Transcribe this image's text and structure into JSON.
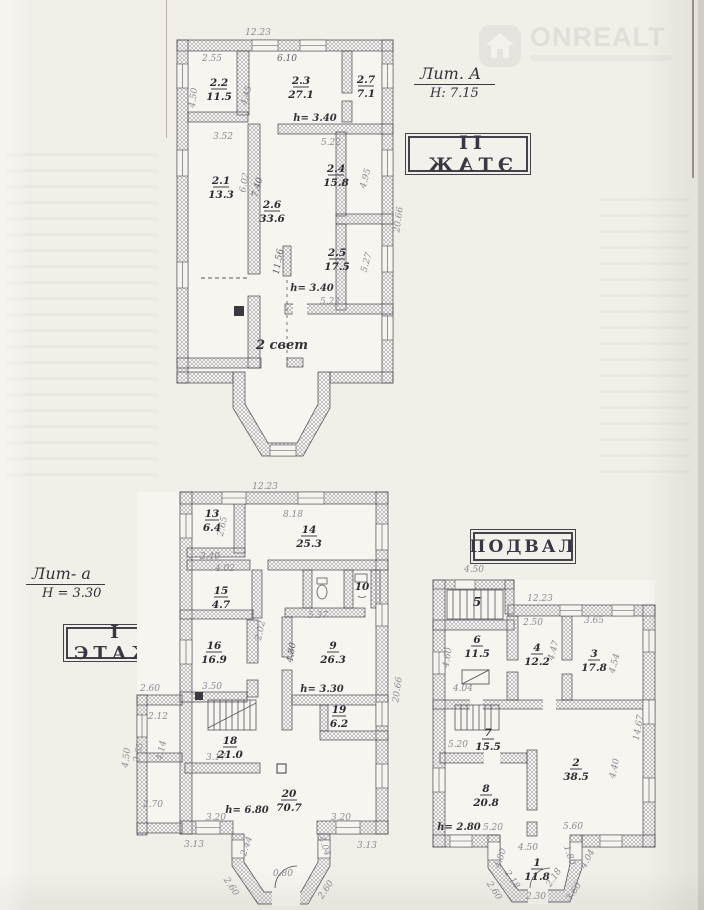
{
  "watermark": {
    "brand": "ONREALT"
  },
  "floor2": {
    "stamp": "II ЭТАЖ",
    "lit": "Лит. А",
    "height_note": "H: 7.15",
    "rooms": [
      {
        "num": "2.2",
        "area": "11.5"
      },
      {
        "num": "2.3",
        "area": "27.1"
      },
      {
        "num": "2.7",
        "area": "7.1"
      },
      {
        "num": "2.1",
        "area": "13.3"
      },
      {
        "num": "2.4",
        "area": "15.8"
      },
      {
        "num": "2.6",
        "area": "33.6"
      },
      {
        "num": "2.5",
        "area": "17.5"
      }
    ],
    "notes": [
      "h= 3.40",
      "h= 3.40",
      "2 свет"
    ],
    "dims": [
      "12.23",
      "2.55",
      "6.10",
      "4.50",
      "4.45",
      "3.52",
      "5.22",
      "6.02",
      "7.40",
      "4.95",
      "20.66",
      "11.56",
      "5.27",
      "5.22"
    ]
  },
  "floor1": {
    "stamp": "I ЭТАЖ",
    "lit": "Лит- а",
    "height_note": "H = 3.30",
    "rooms": [
      {
        "num": "13",
        "area": "6.4"
      },
      {
        "num": "14",
        "area": "25.3"
      },
      {
        "num": "15",
        "area": "4.7"
      },
      {
        "num": "16",
        "area": "16.9"
      },
      {
        "num": "9",
        "area": "26.3"
      },
      {
        "num": "19",
        "area": "6.2"
      },
      {
        "num": "18",
        "area": "21.0"
      },
      {
        "num": "20",
        "area": "70.7"
      },
      {
        "num": "10"
      }
    ],
    "notes": [
      "h= 3.30",
      "h= 6.80"
    ],
    "dims": [
      "12.23",
      "2.65",
      "2.40",
      "8.18",
      "4.02",
      "5.37",
      "2.02",
      "4.80",
      "3.50",
      "2.60",
      "2.12",
      "2.65",
      "4.14",
      "4.50",
      "2.70",
      "3.17",
      "20.66",
      "3.20",
      "3.20",
      "3.13",
      "3.13",
      "2.44",
      "4.04",
      "0.80",
      "2.60",
      "2.60"
    ]
  },
  "basement": {
    "stamp": "ПОДВАЛ",
    "rooms": [
      {
        "num": "5"
      },
      {
        "num": "6",
        "area": "11.5"
      },
      {
        "num": "4",
        "area": "12.2"
      },
      {
        "num": "3",
        "area": "17.8"
      },
      {
        "num": "7",
        "area": "15.5"
      },
      {
        "num": "8",
        "area": "20.8"
      },
      {
        "num": "2",
        "area": "38.5"
      },
      {
        "num": "1",
        "area": "11.8"
      }
    ],
    "notes": [
      "h= 2.80"
    ],
    "dims": [
      "4.50",
      "12.23",
      "2.50",
      "3.65",
      "4.60",
      "4.47",
      "4.54",
      "4.04",
      "14.67",
      "5.20",
      "5.20",
      "5.60",
      "4.40",
      "4.50",
      "4.80",
      "1.80",
      "2.18",
      "2.18",
      "2.60",
      "3.60",
      "4.04",
      "2.30"
    ]
  }
}
